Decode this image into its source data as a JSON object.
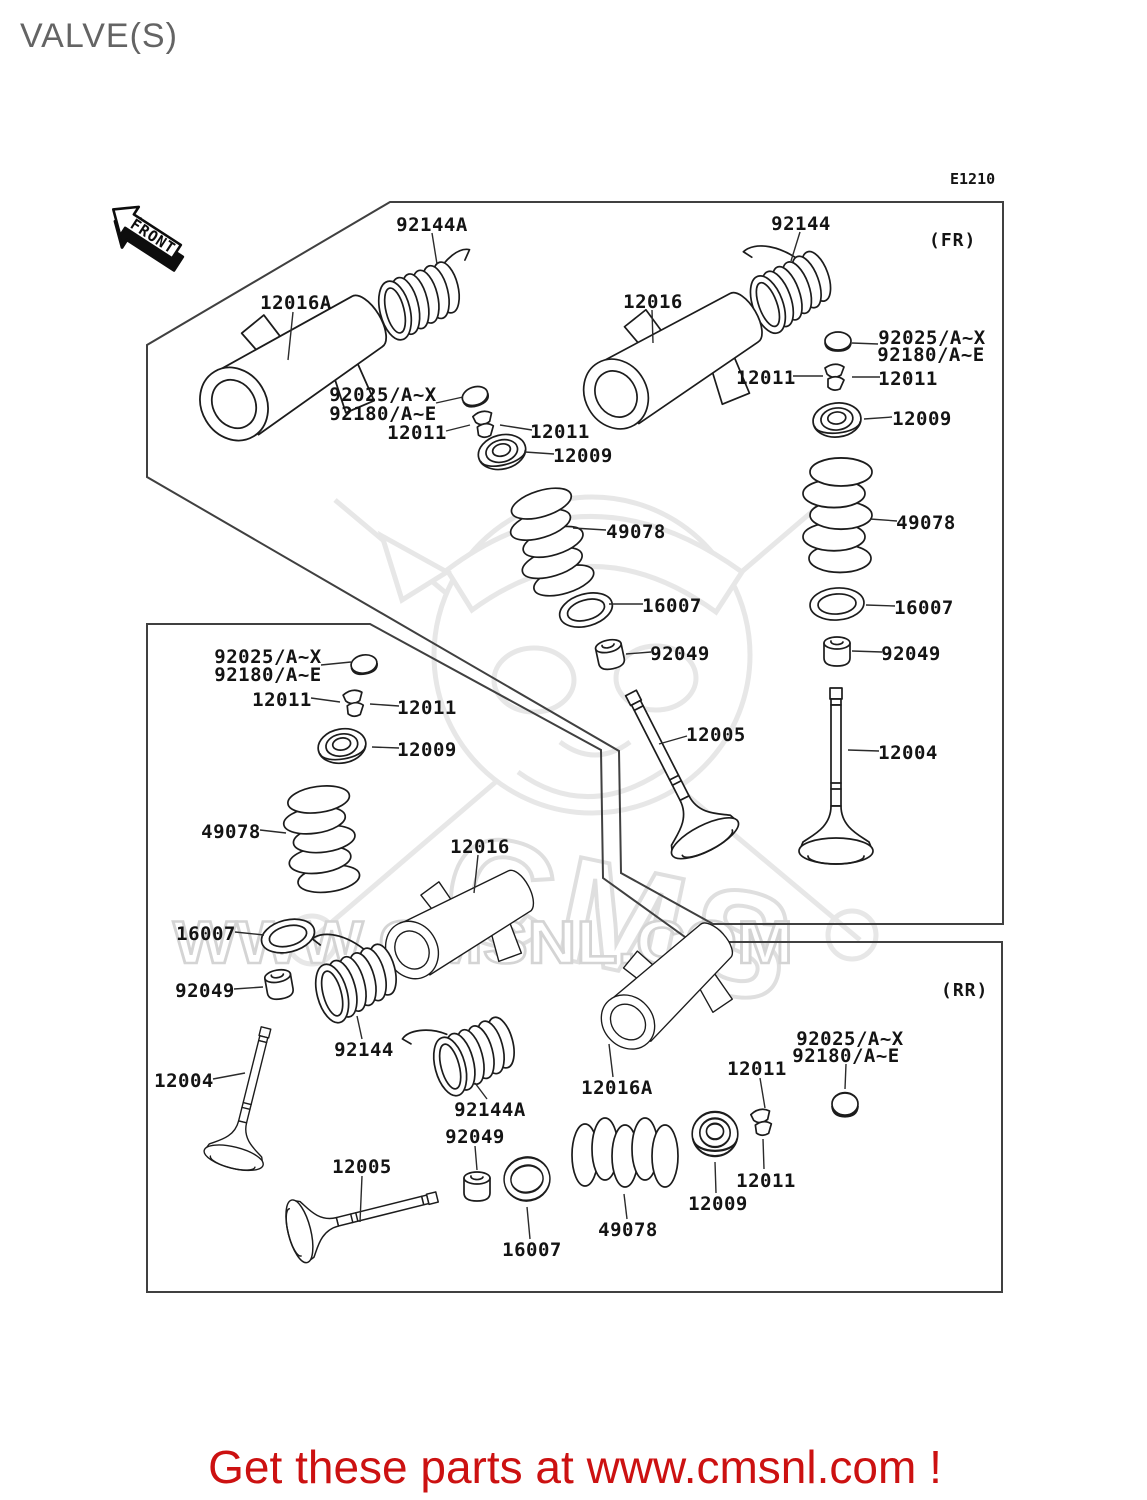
{
  "title": "VALVE(S)",
  "diagram_code": "E1210",
  "front_arrow": {
    "label": "FRONT"
  },
  "sections": {
    "fr": "(FR)",
    "rr": "(RR)"
  },
  "watermark": {
    "brand": "CMS",
    "url_text": "WWW.CMSNL.COM"
  },
  "footer": {
    "text": "Get these parts at www.cmsnl.com !",
    "color": "#cc1111"
  },
  "colors": {
    "line": "#1c1c1c",
    "box": "#404040",
    "label": "#141414",
    "title_gray": "#646464",
    "watermark_gray": "#e7e7e7",
    "footer_red": "#cc1111"
  },
  "unique_part_numbers": [
    "12004",
    "12005",
    "12009",
    "12011",
    "12016",
    "12016A",
    "16007",
    "49078",
    "92025/A~X",
    "92049",
    "92144",
    "92144A",
    "92180/A~E"
  ],
  "labels": [
    {
      "s": "fr-left",
      "t": "92144A",
      "x": 432,
      "y": 224,
      "line": [
        432,
        233,
        437,
        264
      ]
    },
    {
      "s": "fr-left",
      "t": "12016A",
      "x": 296,
      "y": 302,
      "line": [
        293,
        312,
        288,
        360
      ]
    },
    {
      "s": "fr-left",
      "t": "92025/A~X",
      "x": 383,
      "y": 394,
      "line": null
    },
    {
      "s": "fr-left",
      "t": "92180/A~E",
      "x": 383,
      "y": 413,
      "line": [
        436,
        403,
        463,
        397
      ]
    },
    {
      "s": "fr-left",
      "t": "12011",
      "x": 417,
      "y": 432,
      "line": [
        446,
        431,
        470,
        425
      ]
    },
    {
      "s": "fr-left",
      "t": "12011",
      "x": 560,
      "y": 431,
      "line": [
        532,
        430,
        500,
        425
      ]
    },
    {
      "s": "fr-left",
      "t": "12009",
      "x": 583,
      "y": 455,
      "line": [
        554,
        454,
        525,
        452
      ]
    },
    {
      "s": "fr-left",
      "t": "49078",
      "x": 636,
      "y": 531,
      "line": [
        606,
        530,
        573,
        528
      ]
    },
    {
      "s": "fr-left",
      "t": "16007",
      "x": 672,
      "y": 605,
      "line": [
        643,
        604,
        609,
        604
      ]
    },
    {
      "s": "fr-left",
      "t": "92049",
      "x": 680,
      "y": 653,
      "line": [
        651,
        652,
        626,
        654
      ]
    },
    {
      "s": "fr-left",
      "t": "12005",
      "x": 716,
      "y": 734,
      "line": [
        687,
        736,
        659,
        744
      ]
    },
    {
      "s": "fr-right",
      "t": "92144",
      "x": 801,
      "y": 223,
      "line": [
        800,
        232,
        791,
        261
      ]
    },
    {
      "s": "fr-right",
      "t": "12016",
      "x": 653,
      "y": 301,
      "line": [
        652,
        310,
        653,
        343
      ]
    },
    {
      "s": "fr-right",
      "t": "92025/A~X",
      "x": 932,
      "y": 337,
      "line": null
    },
    {
      "s": "fr-right",
      "t": "92180/A~E",
      "x": 931,
      "y": 354,
      "line": [
        878,
        344,
        852,
        343
      ]
    },
    {
      "s": "fr-right",
      "t": "12011",
      "x": 766,
      "y": 377,
      "line": [
        793,
        376,
        823,
        376
      ]
    },
    {
      "s": "fr-right",
      "t": "12011",
      "x": 908,
      "y": 378,
      "line": [
        880,
        377,
        852,
        377
      ]
    },
    {
      "s": "fr-right",
      "t": "12009",
      "x": 922,
      "y": 418,
      "line": [
        892,
        417,
        864,
        419
      ]
    },
    {
      "s": "fr-right",
      "t": "49078",
      "x": 926,
      "y": 522,
      "line": [
        897,
        521,
        870,
        519
      ]
    },
    {
      "s": "fr-right",
      "t": "16007",
      "x": 924,
      "y": 607,
      "line": [
        895,
        606,
        866,
        605
      ]
    },
    {
      "s": "fr-right",
      "t": "92049",
      "x": 911,
      "y": 653,
      "line": [
        882,
        652,
        852,
        651
      ]
    },
    {
      "s": "fr-right",
      "t": "12004",
      "x": 908,
      "y": 752,
      "line": [
        879,
        751,
        848,
        750
      ]
    },
    {
      "s": "rr-left",
      "t": "92025/A~X",
      "x": 268,
      "y": 656,
      "line": null
    },
    {
      "s": "rr-left",
      "t": "92180/A~E",
      "x": 268,
      "y": 674,
      "line": [
        321,
        665,
        351,
        662
      ]
    },
    {
      "s": "rr-left",
      "t": "12011",
      "x": 282,
      "y": 699,
      "line": [
        311,
        698,
        340,
        702
      ]
    },
    {
      "s": "rr-left",
      "t": "12011",
      "x": 427,
      "y": 707,
      "line": [
        399,
        706,
        370,
        704
      ]
    },
    {
      "s": "rr-left",
      "t": "12009",
      "x": 427,
      "y": 749,
      "line": [
        399,
        748,
        372,
        747
      ]
    },
    {
      "s": "rr-left",
      "t": "49078",
      "x": 231,
      "y": 831,
      "line": [
        260,
        830,
        286,
        833
      ]
    },
    {
      "s": "rr-left",
      "t": "16007",
      "x": 206,
      "y": 933,
      "line": [
        235,
        932,
        264,
        935
      ]
    },
    {
      "s": "rr-left",
      "t": "92049",
      "x": 205,
      "y": 990,
      "line": [
        234,
        989,
        263,
        987
      ]
    },
    {
      "s": "rr-left",
      "t": "12004",
      "x": 184,
      "y": 1080,
      "line": [
        213,
        1079,
        245,
        1073
      ]
    },
    {
      "s": "rr-mid",
      "t": "12016",
      "x": 480,
      "y": 846,
      "line": [
        478,
        855,
        474,
        893
      ]
    },
    {
      "s": "rr-mid",
      "t": "12016A",
      "x": 617,
      "y": 1087,
      "line": [
        613,
        1077,
        609,
        1044
      ]
    },
    {
      "s": "rr-mid",
      "t": "92144",
      "x": 364,
      "y": 1049,
      "line": [
        362,
        1039,
        357,
        1016
      ]
    },
    {
      "s": "rr-mid",
      "t": "92144A",
      "x": 490,
      "y": 1109,
      "line": [
        487,
        1099,
        475,
        1083
      ]
    },
    {
      "s": "rr-mid",
      "t": "92049",
      "x": 475,
      "y": 1136,
      "line": [
        475,
        1146,
        477,
        1170
      ]
    },
    {
      "s": "rr-mid",
      "t": "12005",
      "x": 362,
      "y": 1166,
      "line": [
        362,
        1176,
        360,
        1222
      ]
    },
    {
      "s": "rr-mid",
      "t": "16007",
      "x": 532,
      "y": 1249,
      "line": [
        530,
        1239,
        527,
        1207
      ]
    },
    {
      "s": "rr-mid",
      "t": "49078",
      "x": 628,
      "y": 1229,
      "line": [
        627,
        1219,
        624,
        1194
      ]
    },
    {
      "s": "rr-mid",
      "t": "12009",
      "x": 718,
      "y": 1203,
      "line": [
        716,
        1193,
        715,
        1162
      ]
    },
    {
      "s": "rr-mid",
      "t": "12011",
      "x": 766,
      "y": 1180,
      "line": [
        764,
        1169,
        763,
        1139
      ]
    },
    {
      "s": "rr-mid",
      "t": "12011",
      "x": 757,
      "y": 1068,
      "line": [
        760,
        1078,
        765,
        1108
      ]
    },
    {
      "s": "rr-mid",
      "t": "92025/A~X",
      "x": 850,
      "y": 1038,
      "line": null
    },
    {
      "s": "rr-mid",
      "t": "92180/A~E",
      "x": 846,
      "y": 1055,
      "line": [
        846,
        1064,
        845,
        1089
      ]
    }
  ]
}
